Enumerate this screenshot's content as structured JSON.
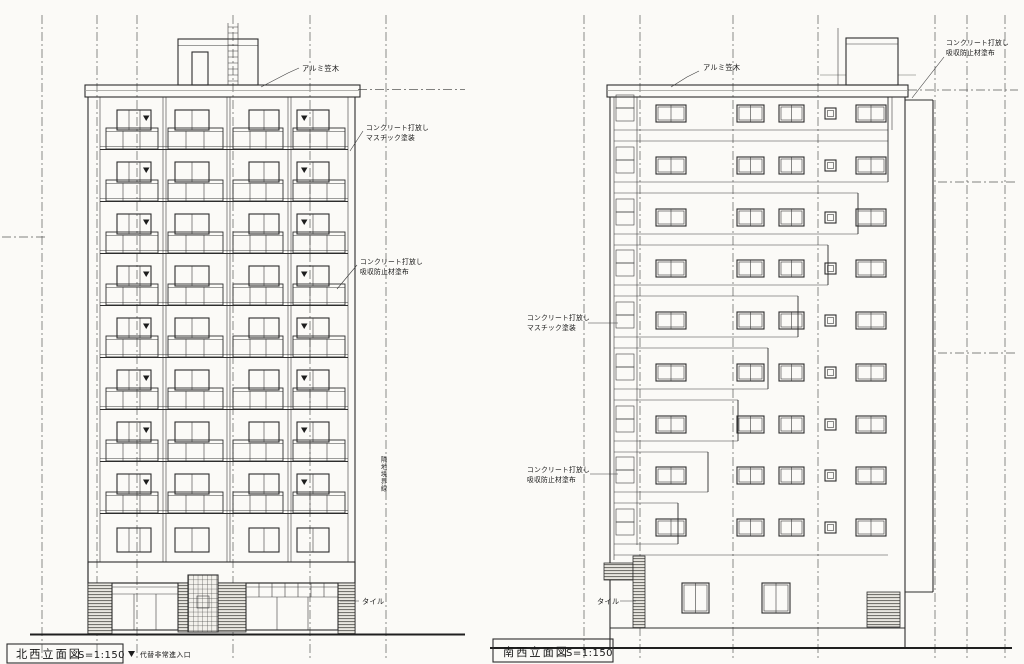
{
  "page": {
    "background": "#fbfaf7",
    "ink": "#2d2d2d"
  },
  "left_elevation": {
    "title": "北西立面図",
    "scale": "S=1:150",
    "note": "代替非常進入口",
    "labels": {
      "coping": "アルミ笠木",
      "mastic_1": "コンクリート打放し",
      "mastic_2": "マスチック塗装",
      "absorb_1": "コンクリート打放し",
      "absorb_2": "吸収防止材塗布",
      "tile": "タイル",
      "boundary": "隣地境界線"
    }
  },
  "right_elevation": {
    "title": "南西立面図",
    "scale": "S=1:150",
    "labels": {
      "coping": "アルミ笠木",
      "absorb_top_1": "コンクリート打放し",
      "absorb_top_2": "吸収防止材塗布",
      "mastic_1": "コンクリート打放し",
      "mastic_2": "マスチック塗装",
      "absorb_left_1": "コンクリート打放し",
      "absorb_left_2": "吸収防止材塗布",
      "tile": "タイル"
    }
  }
}
